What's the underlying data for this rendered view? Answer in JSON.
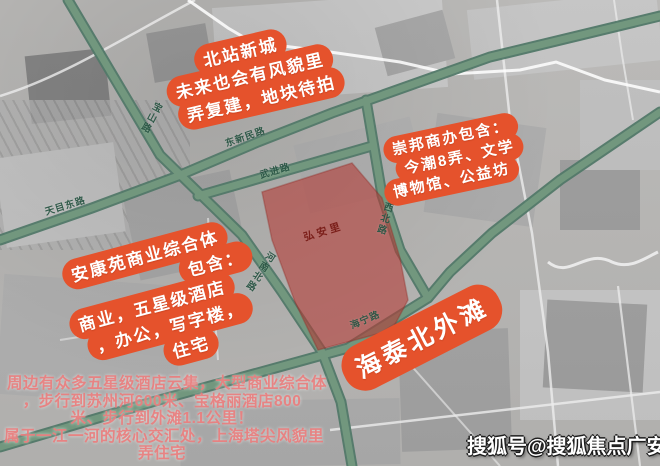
{
  "colors": {
    "bubble_fill": "#e5522c",
    "bubble_text": "#ffffff",
    "road_green": "#6f9584",
    "road_label_text": "#2a5645",
    "site_fill": "#b43c37",
    "site_label_text": "#7b1f1a",
    "footer_text": "#e97d7d",
    "watermark_text": "#ffffff"
  },
  "annotations": {
    "north": {
      "lines": [
        "北站新城",
        "未来也会有风貌里",
        "弄复建，地块待拍"
      ]
    },
    "east": {
      "lines": [
        "崇邦商办包含：",
        "今潮8弄、文学",
        "博物馆、公益坊"
      ]
    },
    "west": {
      "lines": [
        "安康苑商业综合体",
        "包含：",
        "商业，五星级酒店",
        "，办公，写字楼，",
        "住宅"
      ]
    },
    "southeast": {
      "label": "海泰北外滩"
    }
  },
  "site": {
    "label": "弘安里"
  },
  "roads": {
    "baoshan": {
      "label": "宝山路"
    },
    "tianmudong": {
      "label": "天目东路"
    },
    "dongxinmin": {
      "label": "东新民路"
    },
    "wujin": {
      "label": "武进路"
    },
    "jiangxibei": {
      "label": "江西北路"
    },
    "henanbei": {
      "label": "河南北路"
    },
    "haining": {
      "label": "海宁路"
    }
  },
  "footer": {
    "lines": [
      "周边有众多五星级酒店云集，大型商业综合体",
      "，步行到苏州河600米、宝格丽酒店800",
      "米、步行到外滩1.1公里！",
      "属于一江一河的核心交汇处，上海塔尖风貌里",
      "弄住宅"
    ]
  },
  "watermark": {
    "text": "搜狐号@搜狐焦点广安站"
  }
}
